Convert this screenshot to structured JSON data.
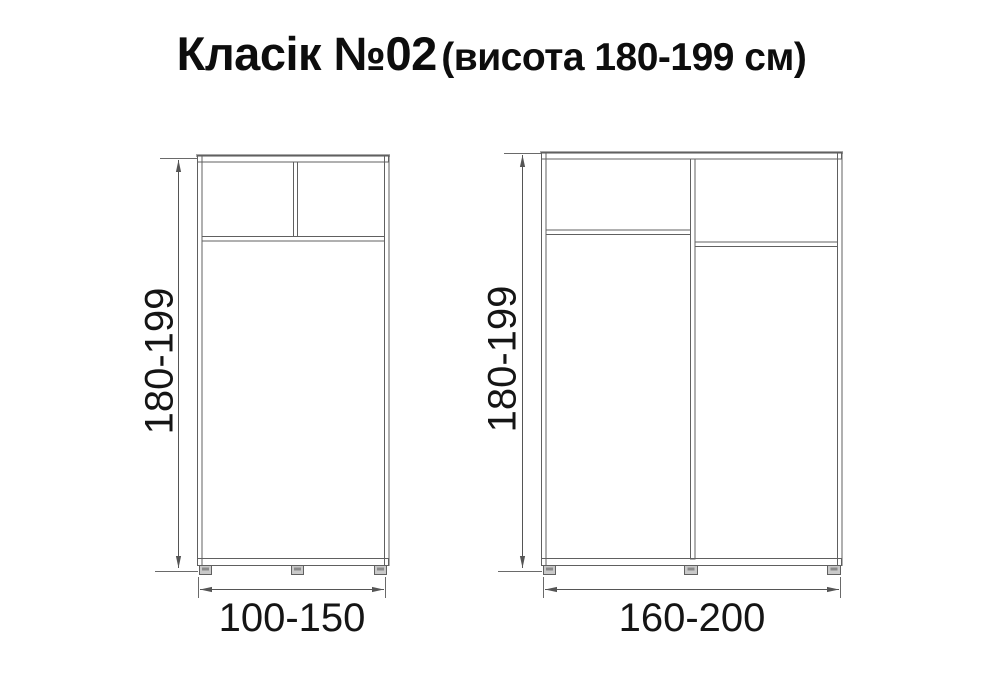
{
  "title": {
    "main": "Класік №02",
    "sub": "(висота 180-199 см)"
  },
  "diagrams": [
    {
      "name": "wardrobe-2-door",
      "height_label": "180-199",
      "width_label": "100-150"
    },
    {
      "name": "wardrobe-3-door",
      "height_label": "180-199",
      "width_label": "160-200"
    }
  ],
  "colors": {
    "line": "#606060",
    "line_light": "#a8a8a8",
    "foot_fill": "#c9c9c9",
    "foot_dark": "#8a8a8a",
    "text": "#151515",
    "background": "#ffffff"
  }
}
